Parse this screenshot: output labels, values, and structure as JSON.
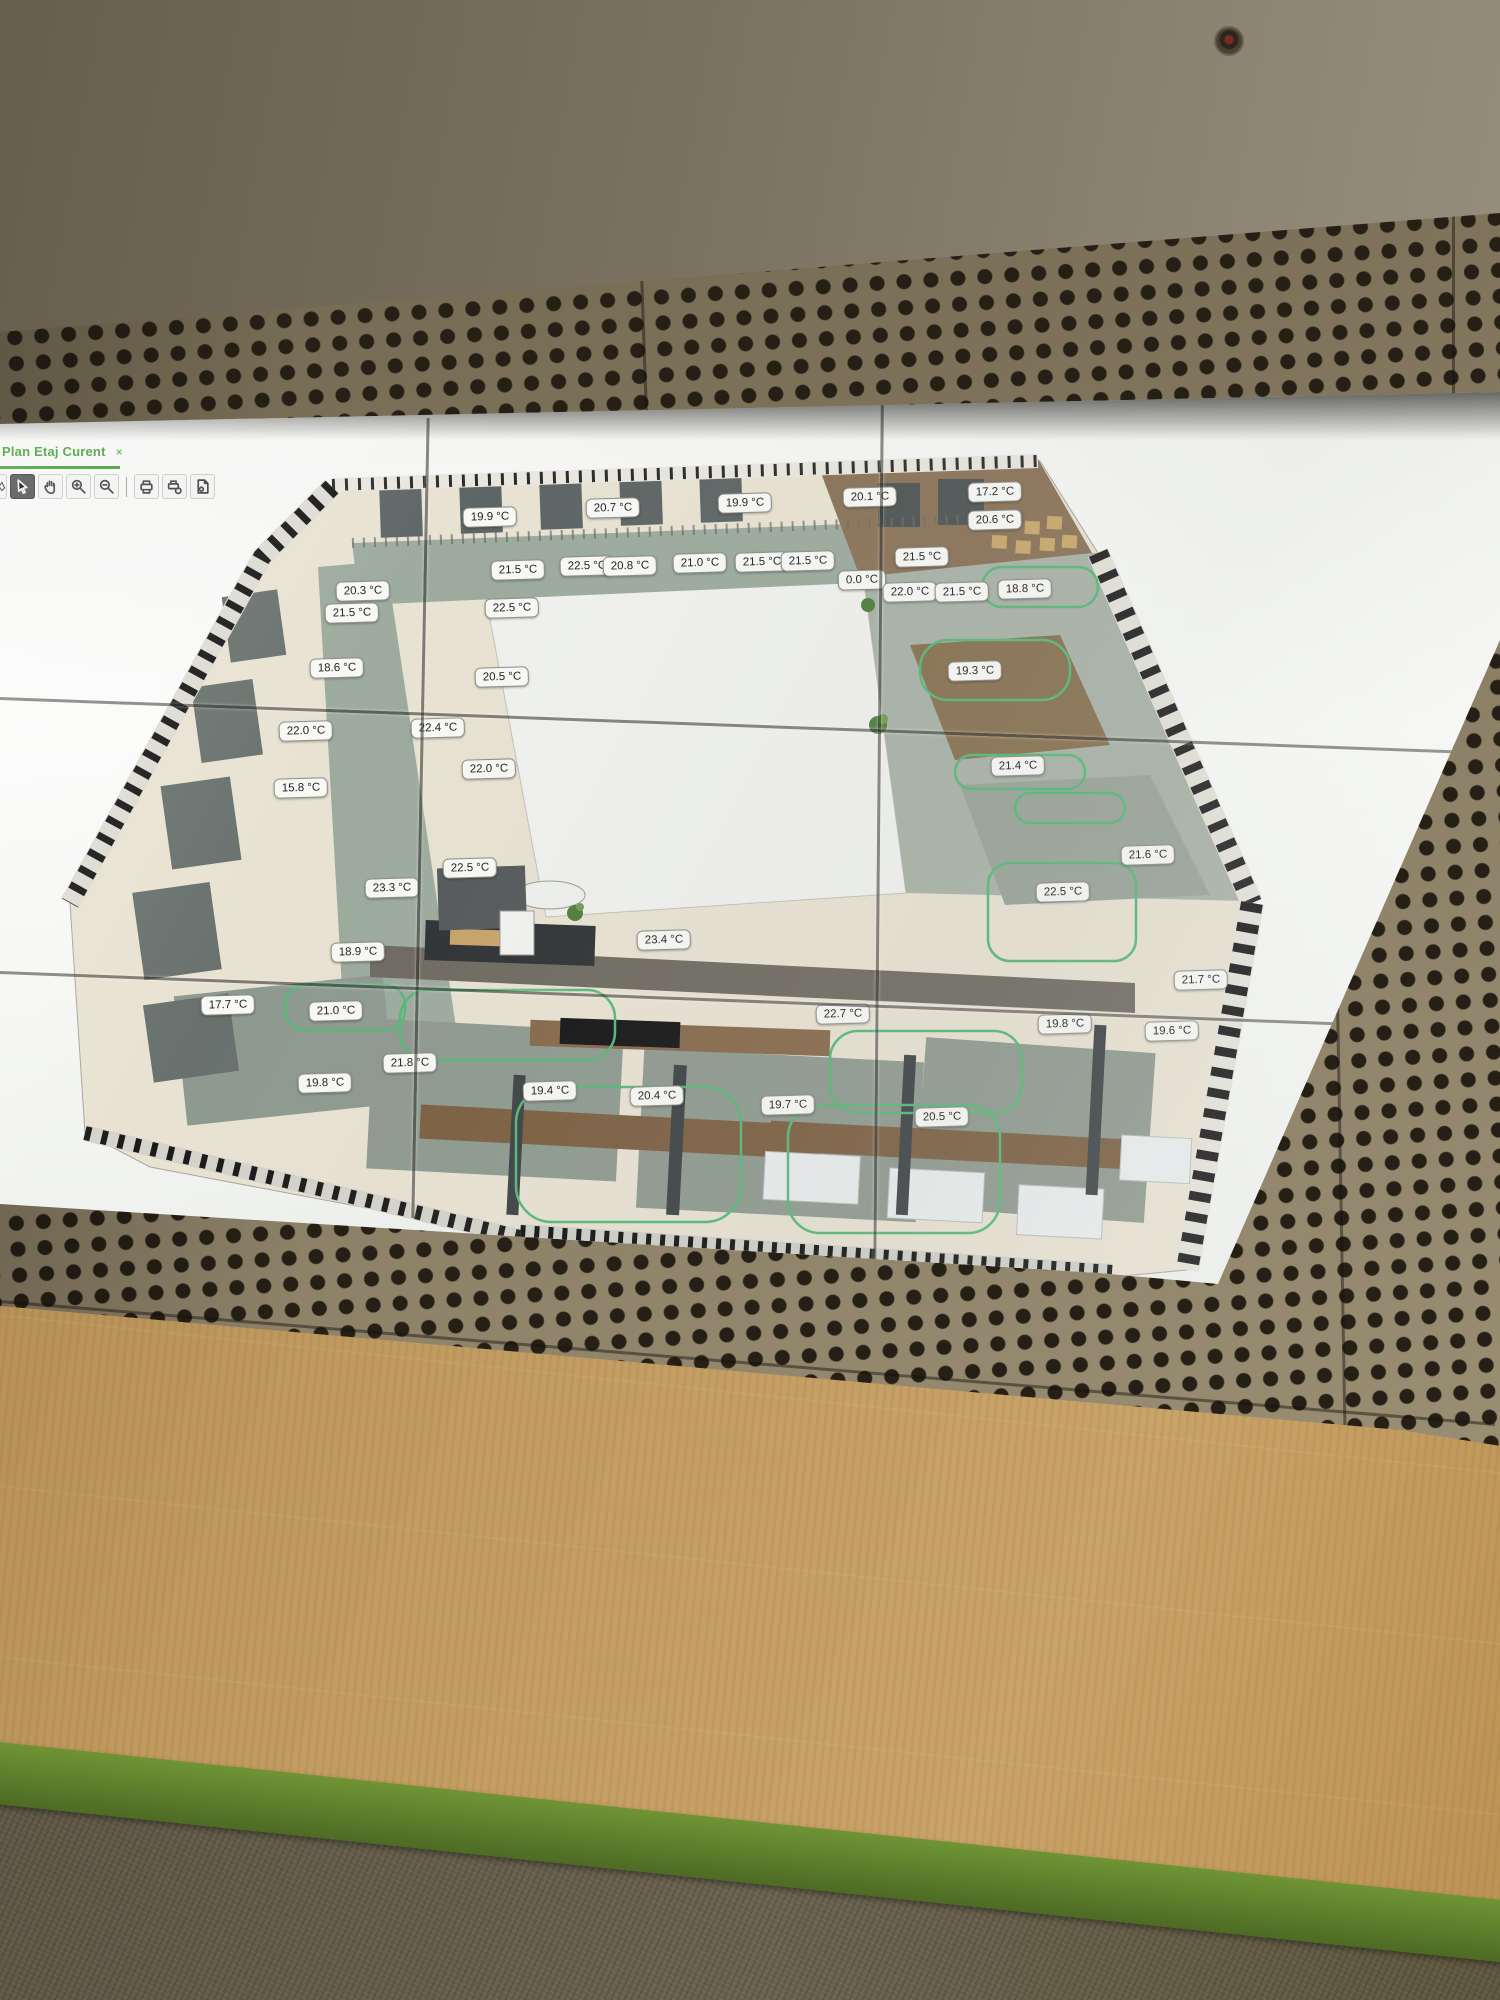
{
  "colors": {
    "tab_green": "#3f9c35",
    "zone_green": "#55b877",
    "label_bg": "#f8f8f5",
    "panel_bronze": "#7d7259",
    "ceiling_taupe": "#7a7160",
    "carpet_tan": "#bb9256",
    "grass_green": "#5c7e2c",
    "carpet_dark": "#655d4a",
    "screen_white": "#f4f5f3"
  },
  "app": {
    "tab": {
      "label": "Plan Etaj Curent",
      "close_label": "×"
    },
    "toolbar": {
      "tools": [
        {
          "name": "select-tool",
          "active": true
        },
        {
          "name": "pan-tool",
          "active": false
        },
        {
          "name": "zoom-in-tool",
          "active": false
        },
        {
          "name": "zoom-out-tool",
          "active": false
        },
        {
          "name": "print-tool",
          "active": false
        },
        {
          "name": "print-setup-tool",
          "active": false
        },
        {
          "name": "page-preview-tool",
          "active": false
        }
      ]
    }
  },
  "plan": {
    "unit": "°C",
    "temperatures": [
      {
        "value": "19.9 °C",
        "x": 490,
        "y": 517
      },
      {
        "value": "20.7 °C",
        "x": 613,
        "y": 508
      },
      {
        "value": "19.9 °C",
        "x": 745,
        "y": 503
      },
      {
        "value": "20.1 °C",
        "x": 870,
        "y": 497
      },
      {
        "value": "17.2 °C",
        "x": 995,
        "y": 492
      },
      {
        "value": "20.6 °C",
        "x": 995,
        "y": 520
      },
      {
        "value": "21.5 °C",
        "x": 518,
        "y": 570
      },
      {
        "value": "22.5 °C",
        "x": 587,
        "y": 566
      },
      {
        "value": "20.8 °C",
        "x": 630,
        "y": 566
      },
      {
        "value": "21.0 °C",
        "x": 700,
        "y": 563
      },
      {
        "value": "21.5 °C",
        "x": 762,
        "y": 562
      },
      {
        "value": "21.5 °C",
        "x": 808,
        "y": 561
      },
      {
        "value": "21.5 °C",
        "x": 922,
        "y": 557
      },
      {
        "value": "0.0 °C",
        "x": 862,
        "y": 580
      },
      {
        "value": "22.0 °C",
        "x": 910,
        "y": 592
      },
      {
        "value": "21.5 °C",
        "x": 962,
        "y": 592
      },
      {
        "value": "18.8 °C",
        "x": 1025,
        "y": 589
      },
      {
        "value": "20.3 °C",
        "x": 363,
        "y": 591
      },
      {
        "value": "21.5 °C",
        "x": 352,
        "y": 613
      },
      {
        "value": "22.5 °C",
        "x": 512,
        "y": 608
      },
      {
        "value": "18.6 °C",
        "x": 337,
        "y": 668
      },
      {
        "value": "20.5 °C",
        "x": 502,
        "y": 677
      },
      {
        "value": "19.3 °C",
        "x": 975,
        "y": 671
      },
      {
        "value": "22.0 °C",
        "x": 306,
        "y": 731
      },
      {
        "value": "22.4 °C",
        "x": 438,
        "y": 728
      },
      {
        "value": "22.0 °C",
        "x": 489,
        "y": 769
      },
      {
        "value": "21.4 °C",
        "x": 1018,
        "y": 766
      },
      {
        "value": "15.8 °C",
        "x": 301,
        "y": 788
      },
      {
        "value": "22.5 °C",
        "x": 470,
        "y": 868
      },
      {
        "value": "21.6 °C",
        "x": 1148,
        "y": 855
      },
      {
        "value": "23.3 °C",
        "x": 392,
        "y": 888
      },
      {
        "value": "22.5 °C",
        "x": 1063,
        "y": 892
      },
      {
        "value": "23.4 °C",
        "x": 664,
        "y": 940
      },
      {
        "value": "18.9 °C",
        "x": 358,
        "y": 952
      },
      {
        "value": "21.7 °C",
        "x": 1201,
        "y": 980
      },
      {
        "value": "17.7 °C",
        "x": 228,
        "y": 1005
      },
      {
        "value": "21.0 °C",
        "x": 336,
        "y": 1011
      },
      {
        "value": "22.7 °C",
        "x": 843,
        "y": 1014
      },
      {
        "value": "19.8 °C",
        "x": 1065,
        "y": 1024
      },
      {
        "value": "19.6 °C",
        "x": 1172,
        "y": 1031
      },
      {
        "value": "21.8 °C",
        "x": 410,
        "y": 1063
      },
      {
        "value": "19.8 °C",
        "x": 325,
        "y": 1083
      },
      {
        "value": "19.4 °C",
        "x": 550,
        "y": 1091
      },
      {
        "value": "20.4 °C",
        "x": 657,
        "y": 1096
      },
      {
        "value": "19.7 °C",
        "x": 788,
        "y": 1105
      },
      {
        "value": "20.5 °C",
        "x": 942,
        "y": 1117
      }
    ]
  }
}
